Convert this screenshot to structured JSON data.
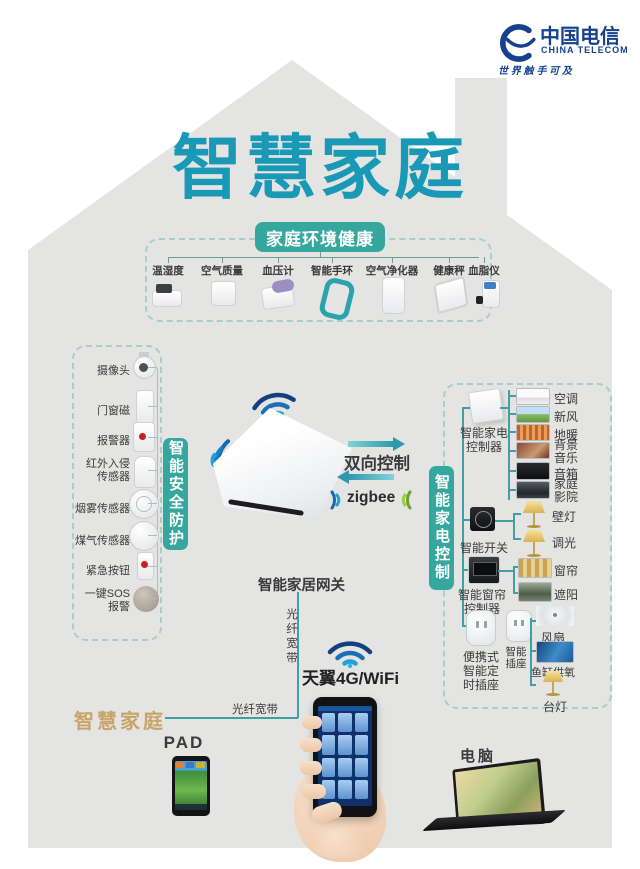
{
  "logo": {
    "name": "中国电信",
    "english": "CHINA TELECOM",
    "slogan": "世 界 触 手 可 及"
  },
  "title": "智慧家庭",
  "health": {
    "badge": "家庭环境健康",
    "items": [
      "温湿度",
      "空气质量",
      "血压计",
      "智能手环",
      "空气净化器",
      "健康秤",
      "血脂仪"
    ]
  },
  "security": {
    "badge": "智能安全防护",
    "items": [
      "摄像头",
      "门窗磁",
      "报警器",
      "红外入侵传感器",
      "烟雾传感器",
      "煤气传感器",
      "紧急按钮",
      "一键SOS报警"
    ]
  },
  "center": {
    "two_way": "双向控制",
    "zigbee": "zigbee",
    "gateway": "智能家居网关",
    "fiber_vertical": "光纤宽带",
    "wifi_4g": "天翼4G/WiFi",
    "fiber_bottom": "光纤宽带"
  },
  "appliance": {
    "badge": "智能家电控制",
    "controller1": "智能家电控制器",
    "group1": [
      "空调",
      "新风",
      "地暖",
      "背景音乐",
      "音箱",
      "家庭影院"
    ],
    "controller2": "智能开关",
    "group2": [
      "壁灯",
      "调光"
    ],
    "controller3": "智能窗帘控制器",
    "group3": [
      "窗帘",
      "遮阳"
    ],
    "controller4": "便携式智能定时插座",
    "controller5": "智能插座",
    "group4": [
      "风扇",
      "鱼缸供氧",
      "台灯"
    ]
  },
  "bottom": {
    "brand": "智慧家庭",
    "pad": "PAD",
    "computer": "电脑"
  },
  "colors": {
    "title_teal": "#1a99b6",
    "badge_teal": "#35a79e",
    "logo_blue": "#16418e",
    "gold": "#c8a469"
  }
}
